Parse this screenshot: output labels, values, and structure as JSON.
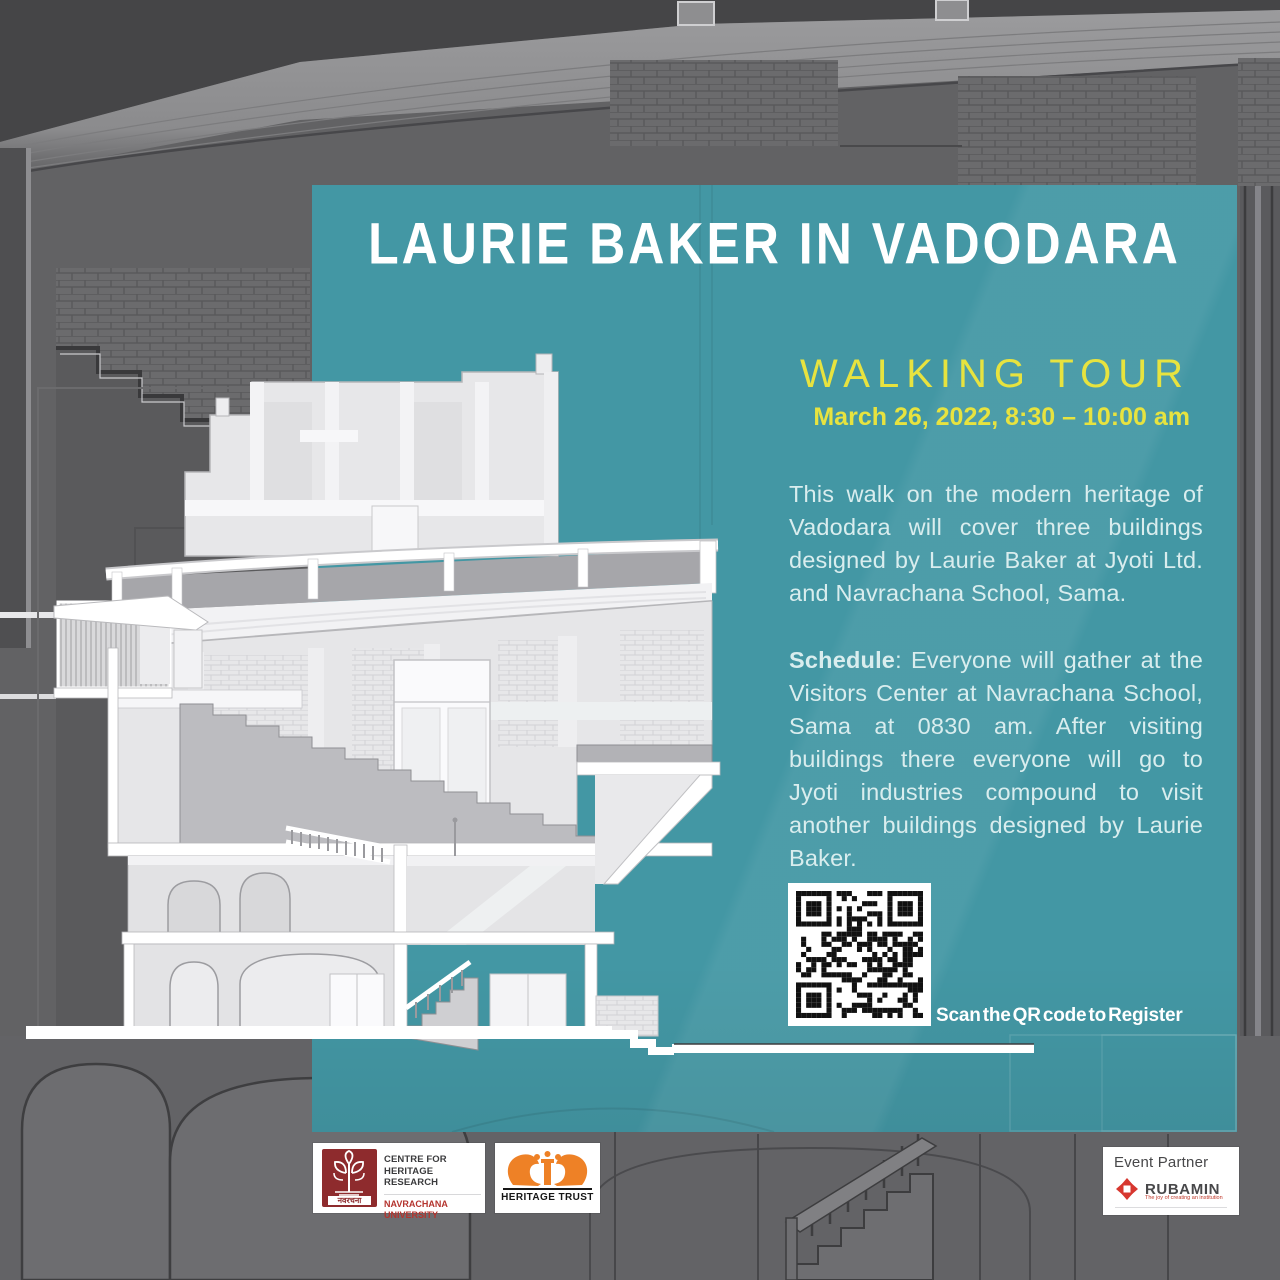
{
  "poster": {
    "title": "LAURIE BAKER IN VADODARA",
    "event_type": "WALKING TOUR",
    "datetime": "March 26, 2022, 8:30 – 10:00 am",
    "intro": "This walk on the modern heritage of Vadodara will cover three buildings designed by Laurie Baker at Jyoti Ltd. and Navrachana School, Sama.",
    "schedule_label": "Schedule",
    "schedule_text": ": Everyone will gather at the Visitors Center at Navrachana School, Sama at 0830 am. After visiting buildings there everyone will go to Jyoti industries compound to visit another buildings designed by Laurie Baker.",
    "qr_caption": "Scan the QR code to Register"
  },
  "logos": {
    "chr": {
      "line1": "CENTRE FOR",
      "line2": "HERITAGE RESEARCH",
      "line3": "NAVRACHANA UNIVERSITY",
      "devanagari": "नवरचना"
    },
    "heritage_trust": {
      "label": "HERITAGE TRUST"
    },
    "event_partner": {
      "heading": "Event Partner",
      "brand": "RUBAMIN",
      "tagline": "The joy of creating an institution"
    }
  },
  "colors": {
    "panel_teal": "#4397a4",
    "accent_yellow": "#e7e33f",
    "body_text": "#d9edee",
    "background_gray": "#626264",
    "chr_maroon": "#8e2b2d",
    "ht_orange": "#ee8126",
    "rubamin_red": "#d7372f"
  }
}
